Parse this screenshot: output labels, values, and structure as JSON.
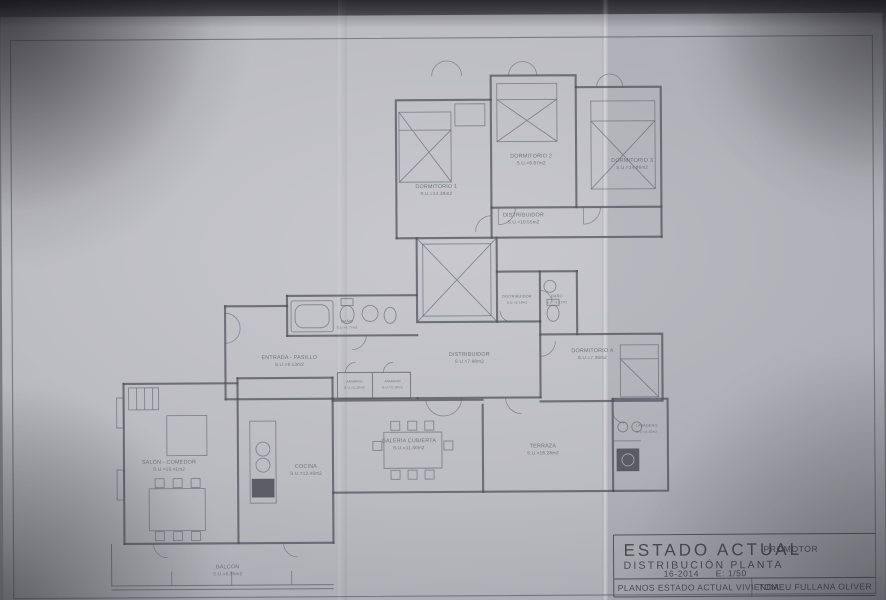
{
  "colors": {
    "paper": "#bcbcc3",
    "ink": "#4c4c58",
    "label_ink": "#5c5c6a"
  },
  "title_block": {
    "title": "ESTADO ACTUAL",
    "subtitle": "DISTRIBUCIÓN PLANTA",
    "project_number": "16-2014",
    "scale": "E: 1/50",
    "promoter_label": "PROMOTOR",
    "plan_name": "PLANOS ESTADO ACTUAL VIVIENDA",
    "promoter_name": "TOMEU FULLANA OLIVER"
  },
  "rooms": {
    "dormitorio1": {
      "label": "DORMITORIO 1",
      "area": "S.U.=14.39m2"
    },
    "dormitorio2": {
      "label": "DORMITORIO 2",
      "area": "S.U.=9.87m2"
    },
    "dormitorio3": {
      "label": "DORMITORIO 3",
      "area": "S.U.=14.86m2"
    },
    "distribuidor1": {
      "label": "DISTRIBUIDOR",
      "area": "S.U.=10.55m2"
    },
    "distribuidor2": {
      "label": "DISTRIBUIDOR",
      "area": "S.U.=3.19m2"
    },
    "bano1": {
      "label": "BAÑO",
      "area": "S.U.=3.17m2"
    },
    "bano2": {
      "label": "BAÑO",
      "area": "S.U.=5.77m2"
    },
    "entrada": {
      "label": "ENTRADA - PASILLO",
      "area": "S.U.=9.13m2"
    },
    "distribuidor3": {
      "label": "DISTRIBUIDOR",
      "area": "S.U.=7.88m2"
    },
    "dormitorio4": {
      "label": "DORMITORIO 4",
      "area": "S.U.=7.36m2"
    },
    "armario1": {
      "label": "ARMARIO",
      "area": "S.U.=1.10m2"
    },
    "armario2": {
      "label": "ARMARIO",
      "area": "S.U.=1.10m2"
    },
    "galeria": {
      "label": "GALERÍA CUBIERTA",
      "area": "S.U.=11.30m2"
    },
    "terraza": {
      "label": "TERRAZA",
      "area": "S.U.=16.28m2"
    },
    "lavadero": {
      "label": "LAVADERO",
      "area": "S.U.=9.40m2"
    },
    "salon": {
      "label": "SALÓN - COMEDOR",
      "area": "S.U.=19.41m2"
    },
    "cocina": {
      "label": "COCINA",
      "area": "S.U.=12.46m2"
    },
    "balcon": {
      "label": "BALCÓN",
      "area": "S.U.=9.95m2"
    }
  }
}
